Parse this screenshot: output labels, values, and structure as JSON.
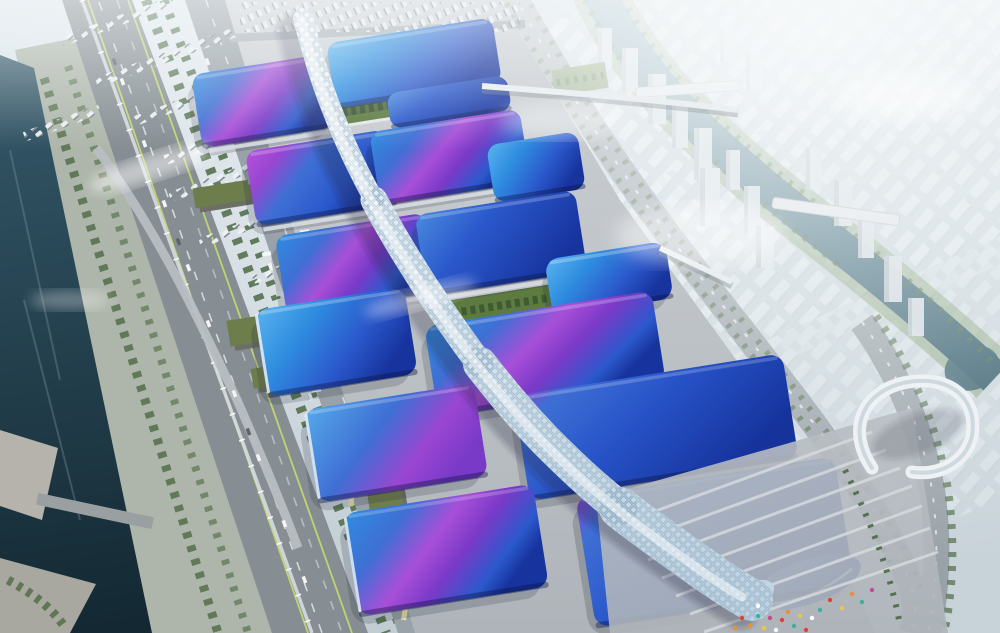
{
  "meta": {
    "domain": "Natural-Image",
    "description": "Aerial architectural rendering of a riverside exhibition and convention center: rows of wavy blue roofs with purple gradient swooshes flank a white serpentine central concourse; elevated highways, canals, parking lots and a hazy white city surround the complex."
  },
  "palette": {
    "sky_top": "#dde6ec",
    "sky_bottom": "#c2ccd3",
    "haze_white": "#f7fafb",
    "city_base": "#c9d4da",
    "tower_face": "#d6dee3",
    "tower_shade": "#b8c2c9",
    "river_light": "#6a93a4",
    "river_dark": "#2e5868",
    "canal_light": "#35596a",
    "canal_dark": "#132832",
    "bank_green": "#7d9a6b",
    "park_green": "#aeb6ab",
    "tree_dark": "#4e6a44",
    "tree_deep": "#3e5c30",
    "apron_light": "#cdd1d5",
    "apron_dark": "#aeb4b9",
    "road_dark": "#868e93",
    "road_mid": "#99a2a8",
    "road_light": "#b8bec2",
    "lane_green": "#c8da6e",
    "dash_white": "#e8ecef",
    "roof_cyan": "#5ab4ee",
    "roof_sky": "#2f8de0",
    "roof_royal": "#2b59cc",
    "roof_blue": "#3f6fd4",
    "roof_deep": "#17339e",
    "magenta": "#b553dc",
    "purple_mid": "#9a46d2",
    "violet_deep": "#7a3ac8",
    "spine_light": "#f4f8fb",
    "spine_shade": "#bdd2e0",
    "spine_grid": "#7896af",
    "courtyard_green": "#5d7a40",
    "warehouse_roof": "#6e7d4c",
    "warehouse_side": "#6d6f66",
    "bus_yellow": "#e6e2a8",
    "concrete": "#b5b3ab",
    "flags": {
      "red": "#d94436",
      "orange": "#e8903a",
      "teal": "#3fae9e",
      "yellow": "#e6c84a",
      "pink": "#c84a8a",
      "white": "#ffffff"
    }
  },
  "scene": {
    "features": [
      "serpentine-white-concourse",
      "wavy-blue-purple-hall-roofs",
      "green-courtyards",
      "elevated-highway-with-canal",
      "city-river-with-bridges",
      "parking-lots",
      "entrance-plaza-with-flags",
      "footbridges",
      "curved-white-gallery-building"
    ],
    "hall_roof_count": 15,
    "courtyard_count": 2,
    "river_bridge_count": 2
  }
}
